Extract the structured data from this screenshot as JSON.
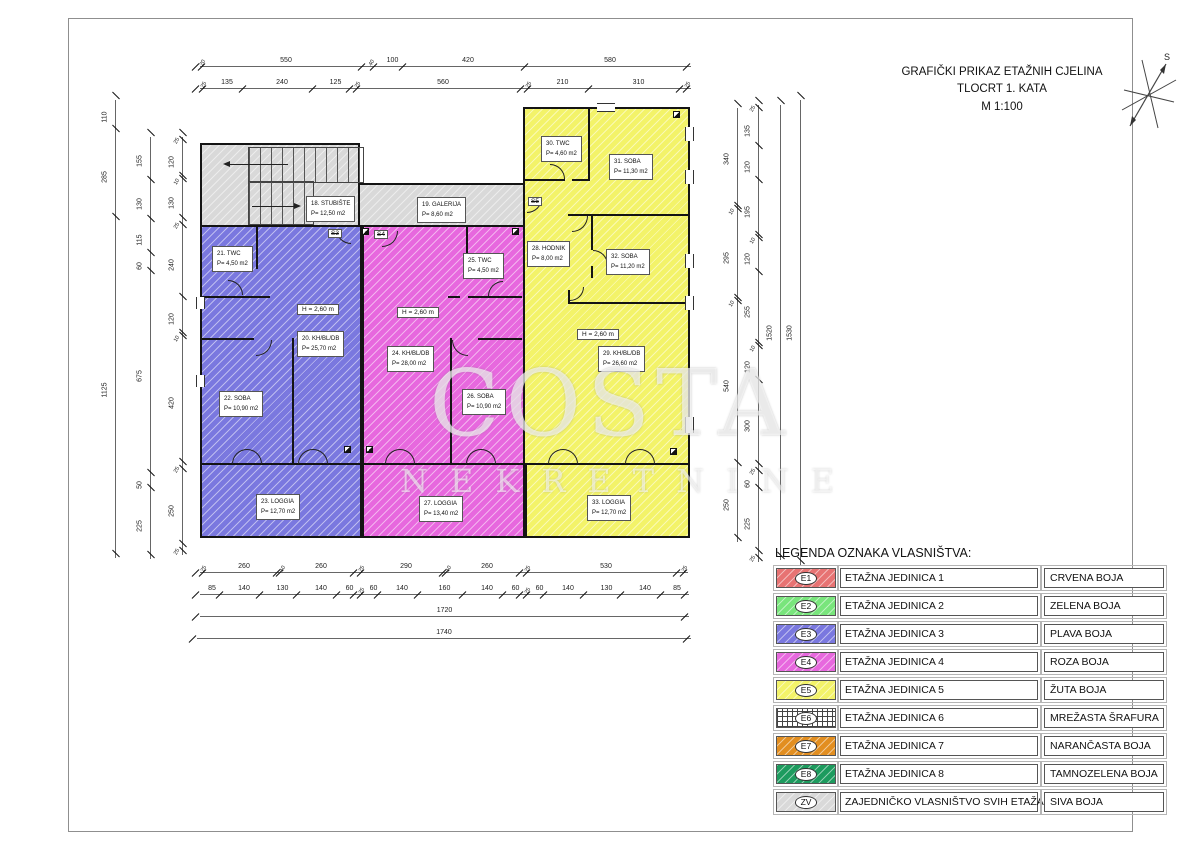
{
  "sheet": {
    "title_lines": [
      "GRAFIČKI PRIKAZ ETAŽNIH CJELINA",
      "TLOCRT 1. KATA",
      "M 1:100"
    ],
    "north_label": "S"
  },
  "watermark": {
    "line1": "COSTA",
    "line2": "NEKRETNINE"
  },
  "plan": {
    "height_label": "H = 2,60 m",
    "stair_tags": {
      "s3": "S3",
      "s4": "S4",
      "s5": "S5"
    },
    "rooms": {
      "r18": {
        "name": "18. STUBIŠTE",
        "area": "P= 12,50 m2"
      },
      "r19": {
        "name": "19. GALERIJA",
        "area": "P= 8,60 m2"
      },
      "r20": {
        "name": "20. KH/BL/DB",
        "area": "P= 25,70 m2"
      },
      "r21": {
        "name": "21. TWC",
        "area": "P= 4,50 m2"
      },
      "r22": {
        "name": "22. SOBA",
        "area": "P= 10,90 m2"
      },
      "r23": {
        "name": "23. LOGGIA",
        "area": "P= 12,70 m2"
      },
      "r24": {
        "name": "24. KH/BL/DB",
        "area": "P= 28,00 m2"
      },
      "r25": {
        "name": "25. TWC",
        "area": "P= 4,50 m2"
      },
      "r26": {
        "name": "26. SOBA",
        "area": "P= 10,90 m2"
      },
      "r27": {
        "name": "27. LOGGIA",
        "area": "P= 13,40 m2"
      },
      "r28": {
        "name": "28. HODNIK",
        "area": "P= 8,00 m2"
      },
      "r29": {
        "name": "29. KH/BL/DB",
        "area": "P= 26,60 m2"
      },
      "r30": {
        "name": "30. TWC",
        "area": "P= 4,60 m2"
      },
      "r31": {
        "name": "31. SOBA",
        "area": "P= 11,30 m2"
      },
      "r32": {
        "name": "32. SOBA",
        "area": "P= 11,20 m2"
      },
      "r33": {
        "name": "33. LOGGIA",
        "area": "P= 12,70 m2"
      }
    }
  },
  "legend": {
    "title": "LEGENDA OZNAKA VLASNIŠTVA:",
    "rows": [
      {
        "code": "E1",
        "label": "ETAŽNA JEDINICA 1",
        "color_name": "CRVENA BOJA",
        "color": "#e77373",
        "pattern": "diag"
      },
      {
        "code": "E2",
        "label": "ETAŽNA JEDINICA 2",
        "color_name": "ZELENA BOJA",
        "color": "#79e57c",
        "pattern": "diag"
      },
      {
        "code": "E3",
        "label": "ETAŽNA JEDINICA 3",
        "color_name": "PLAVA BOJA",
        "color": "#7a78df",
        "pattern": "diag"
      },
      {
        "code": "E4",
        "label": "ETAŽNA JEDINICA 4",
        "color_name": "ROZA BOJA",
        "color": "#e768de",
        "pattern": "diag"
      },
      {
        "code": "E5",
        "label": "ETAŽNA JEDINICA 5",
        "color_name": "ŽUTA BOJA",
        "color": "#f3f369",
        "pattern": "diag"
      },
      {
        "code": "E6",
        "label": "ETAŽNA JEDINICA 6",
        "color_name": "MREŽASTA ŠRAFURA",
        "color": "#ffffff",
        "pattern": "grid"
      },
      {
        "code": "E7",
        "label": "ETAŽNA JEDINICA 7",
        "color_name": "NARANČASTA BOJA",
        "color": "#e28e20",
        "pattern": "diag"
      },
      {
        "code": "E8",
        "label": "ETAŽNA JEDINICA 8",
        "color_name": "TAMNOZELENA BOJA",
        "color": "#1d9b5e",
        "pattern": "diag"
      },
      {
        "code": "ZV",
        "label": "ZAJEDNIČKO VLASNIŠTVO SVIH ETAŽA",
        "color_name": "SIVA BOJA",
        "color": "#d9d9d9",
        "pattern": "diag"
      }
    ]
  },
  "dims": [
    {
      "o": "h",
      "x": 200,
      "y": 66,
      "seg": [
        {
          "l": "20",
          "px": 6,
          "s": 1
        },
        {
          "l": "550",
          "px": 160
        },
        {
          "l": "40",
          "px": 12,
          "s": 1
        },
        {
          "l": "100",
          "px": 29
        },
        {
          "l": "420",
          "px": 122
        },
        {
          "l": "580",
          "px": 162
        }
      ]
    },
    {
      "o": "h",
      "x": 200,
      "y": 88,
      "seg": [
        {
          "l": "25",
          "px": 7,
          "s": 1
        },
        {
          "l": "135",
          "px": 40
        },
        {
          "l": "240",
          "px": 70
        },
        {
          "l": "125",
          "px": 37
        },
        {
          "l": "25",
          "px": 7,
          "s": 1
        },
        {
          "l": "560",
          "px": 164
        },
        {
          "l": "25",
          "px": 7,
          "s": 1
        },
        {
          "l": "210",
          "px": 61
        },
        {
          "l": "310",
          "px": 91
        },
        {
          "l": "25",
          "px": 7,
          "s": 1
        }
      ]
    },
    {
      "o": "h",
      "x": 200,
      "y": 572,
      "seg": [
        {
          "l": "25",
          "px": 7,
          "s": 1
        },
        {
          "l": "260",
          "px": 74
        },
        {
          "l": "10",
          "px": 3,
          "s": 1
        },
        {
          "l": "260",
          "px": 74
        },
        {
          "l": "25",
          "px": 7,
          "s": 1
        },
        {
          "l": "290",
          "px": 82
        },
        {
          "l": "10",
          "px": 3,
          "s": 1
        },
        {
          "l": "260",
          "px": 74
        },
        {
          "l": "25",
          "px": 7,
          "s": 1
        },
        {
          "l": "530",
          "px": 150
        },
        {
          "l": "25",
          "px": 7,
          "s": 1
        }
      ]
    },
    {
      "o": "h",
      "x": 200,
      "y": 594,
      "seg": [
        {
          "l": "85",
          "px": 24
        },
        {
          "l": "140",
          "px": 40
        },
        {
          "l": "130",
          "px": 37
        },
        {
          "l": "140",
          "px": 40
        },
        {
          "l": "60",
          "px": 17
        },
        {
          "l": "25",
          "px": 7,
          "s": 1
        },
        {
          "l": "60",
          "px": 17
        },
        {
          "l": "140",
          "px": 40
        },
        {
          "l": "160",
          "px": 45
        },
        {
          "l": "140",
          "px": 40
        },
        {
          "l": "60",
          "px": 17
        },
        {
          "l": "25",
          "px": 7,
          "s": 1
        },
        {
          "l": "60",
          "px": 17
        },
        {
          "l": "140",
          "px": 40
        },
        {
          "l": "130",
          "px": 37
        },
        {
          "l": "140",
          "px": 40
        },
        {
          "l": "85",
          "px": 24
        }
      ]
    },
    {
      "o": "h",
      "x": 200,
      "y": 616,
      "seg": [
        {
          "l": "1720",
          "px": 489
        }
      ]
    },
    {
      "o": "h",
      "x": 197,
      "y": 638,
      "seg": [
        {
          "l": "1740",
          "px": 494
        }
      ]
    },
    {
      "o": "v",
      "x": 115,
      "y": 100,
      "seg": [
        {
          "l": "110",
          "px": 33
        },
        {
          "l": "285",
          "px": 88
        },
        {
          "l": "1125",
          "px": 337
        }
      ]
    },
    {
      "o": "v",
      "x": 150,
      "y": 137,
      "seg": [
        {
          "l": "155",
          "px": 47
        },
        {
          "l": "130",
          "px": 39
        },
        {
          "l": "115",
          "px": 34
        },
        {
          "l": "60",
          "px": 18
        },
        {
          "l": "675",
          "px": 202
        },
        {
          "l": "50",
          "px": 15
        },
        {
          "l": "225",
          "px": 67
        }
      ]
    },
    {
      "o": "v",
      "x": 182,
      "y": 137,
      "seg": [
        {
          "l": "25",
          "px": 7,
          "s": 1
        },
        {
          "l": "120",
          "px": 36
        },
        {
          "l": "10",
          "px": 3,
          "s": 1
        },
        {
          "l": "130",
          "px": 39
        },
        {
          "l": "25",
          "px": 7,
          "s": 1
        },
        {
          "l": "240",
          "px": 72
        },
        {
          "l": "120",
          "px": 36
        },
        {
          "l": "10",
          "px": 3,
          "s": 1
        },
        {
          "l": "420",
          "px": 126
        },
        {
          "l": "25",
          "px": 7,
          "s": 1
        },
        {
          "l": "250",
          "px": 75
        },
        {
          "l": "25",
          "px": 7,
          "s": 1
        }
      ]
    },
    {
      "o": "v",
      "x": 737,
      "y": 108,
      "seg": [
        {
          "l": "340",
          "px": 102
        },
        {
          "l": "10",
          "px": 3,
          "s": 1
        },
        {
          "l": "295",
          "px": 89
        },
        {
          "l": "10",
          "px": 3,
          "s": 1
        },
        {
          "l": "540",
          "px": 162
        },
        {
          "l": "250",
          "px": 75
        }
      ]
    },
    {
      "o": "v",
      "x": 758,
      "y": 105,
      "seg": [
        {
          "l": "25",
          "px": 7,
          "s": 1
        },
        {
          "l": "135",
          "px": 38
        },
        {
          "l": "120",
          "px": 34
        },
        {
          "l": "195",
          "px": 55
        },
        {
          "l": "10",
          "px": 3,
          "s": 1
        },
        {
          "l": "120",
          "px": 34
        },
        {
          "l": "255",
          "px": 71
        },
        {
          "l": "10",
          "px": 3,
          "s": 1
        },
        {
          "l": "120",
          "px": 34
        },
        {
          "l": "300",
          "px": 84
        },
        {
          "l": "25",
          "px": 7,
          "s": 1
        },
        {
          "l": "60",
          "px": 17
        },
        {
          "l": "225",
          "px": 63
        },
        {
          "l": "25",
          "px": 7,
          "s": 1
        }
      ]
    },
    {
      "o": "v",
      "x": 780,
      "y": 105,
      "seg": [
        {
          "l": "1520",
          "px": 455
        }
      ]
    },
    {
      "o": "v",
      "x": 800,
      "y": 100,
      "seg": [
        {
          "l": "1530",
          "px": 465
        }
      ]
    }
  ]
}
